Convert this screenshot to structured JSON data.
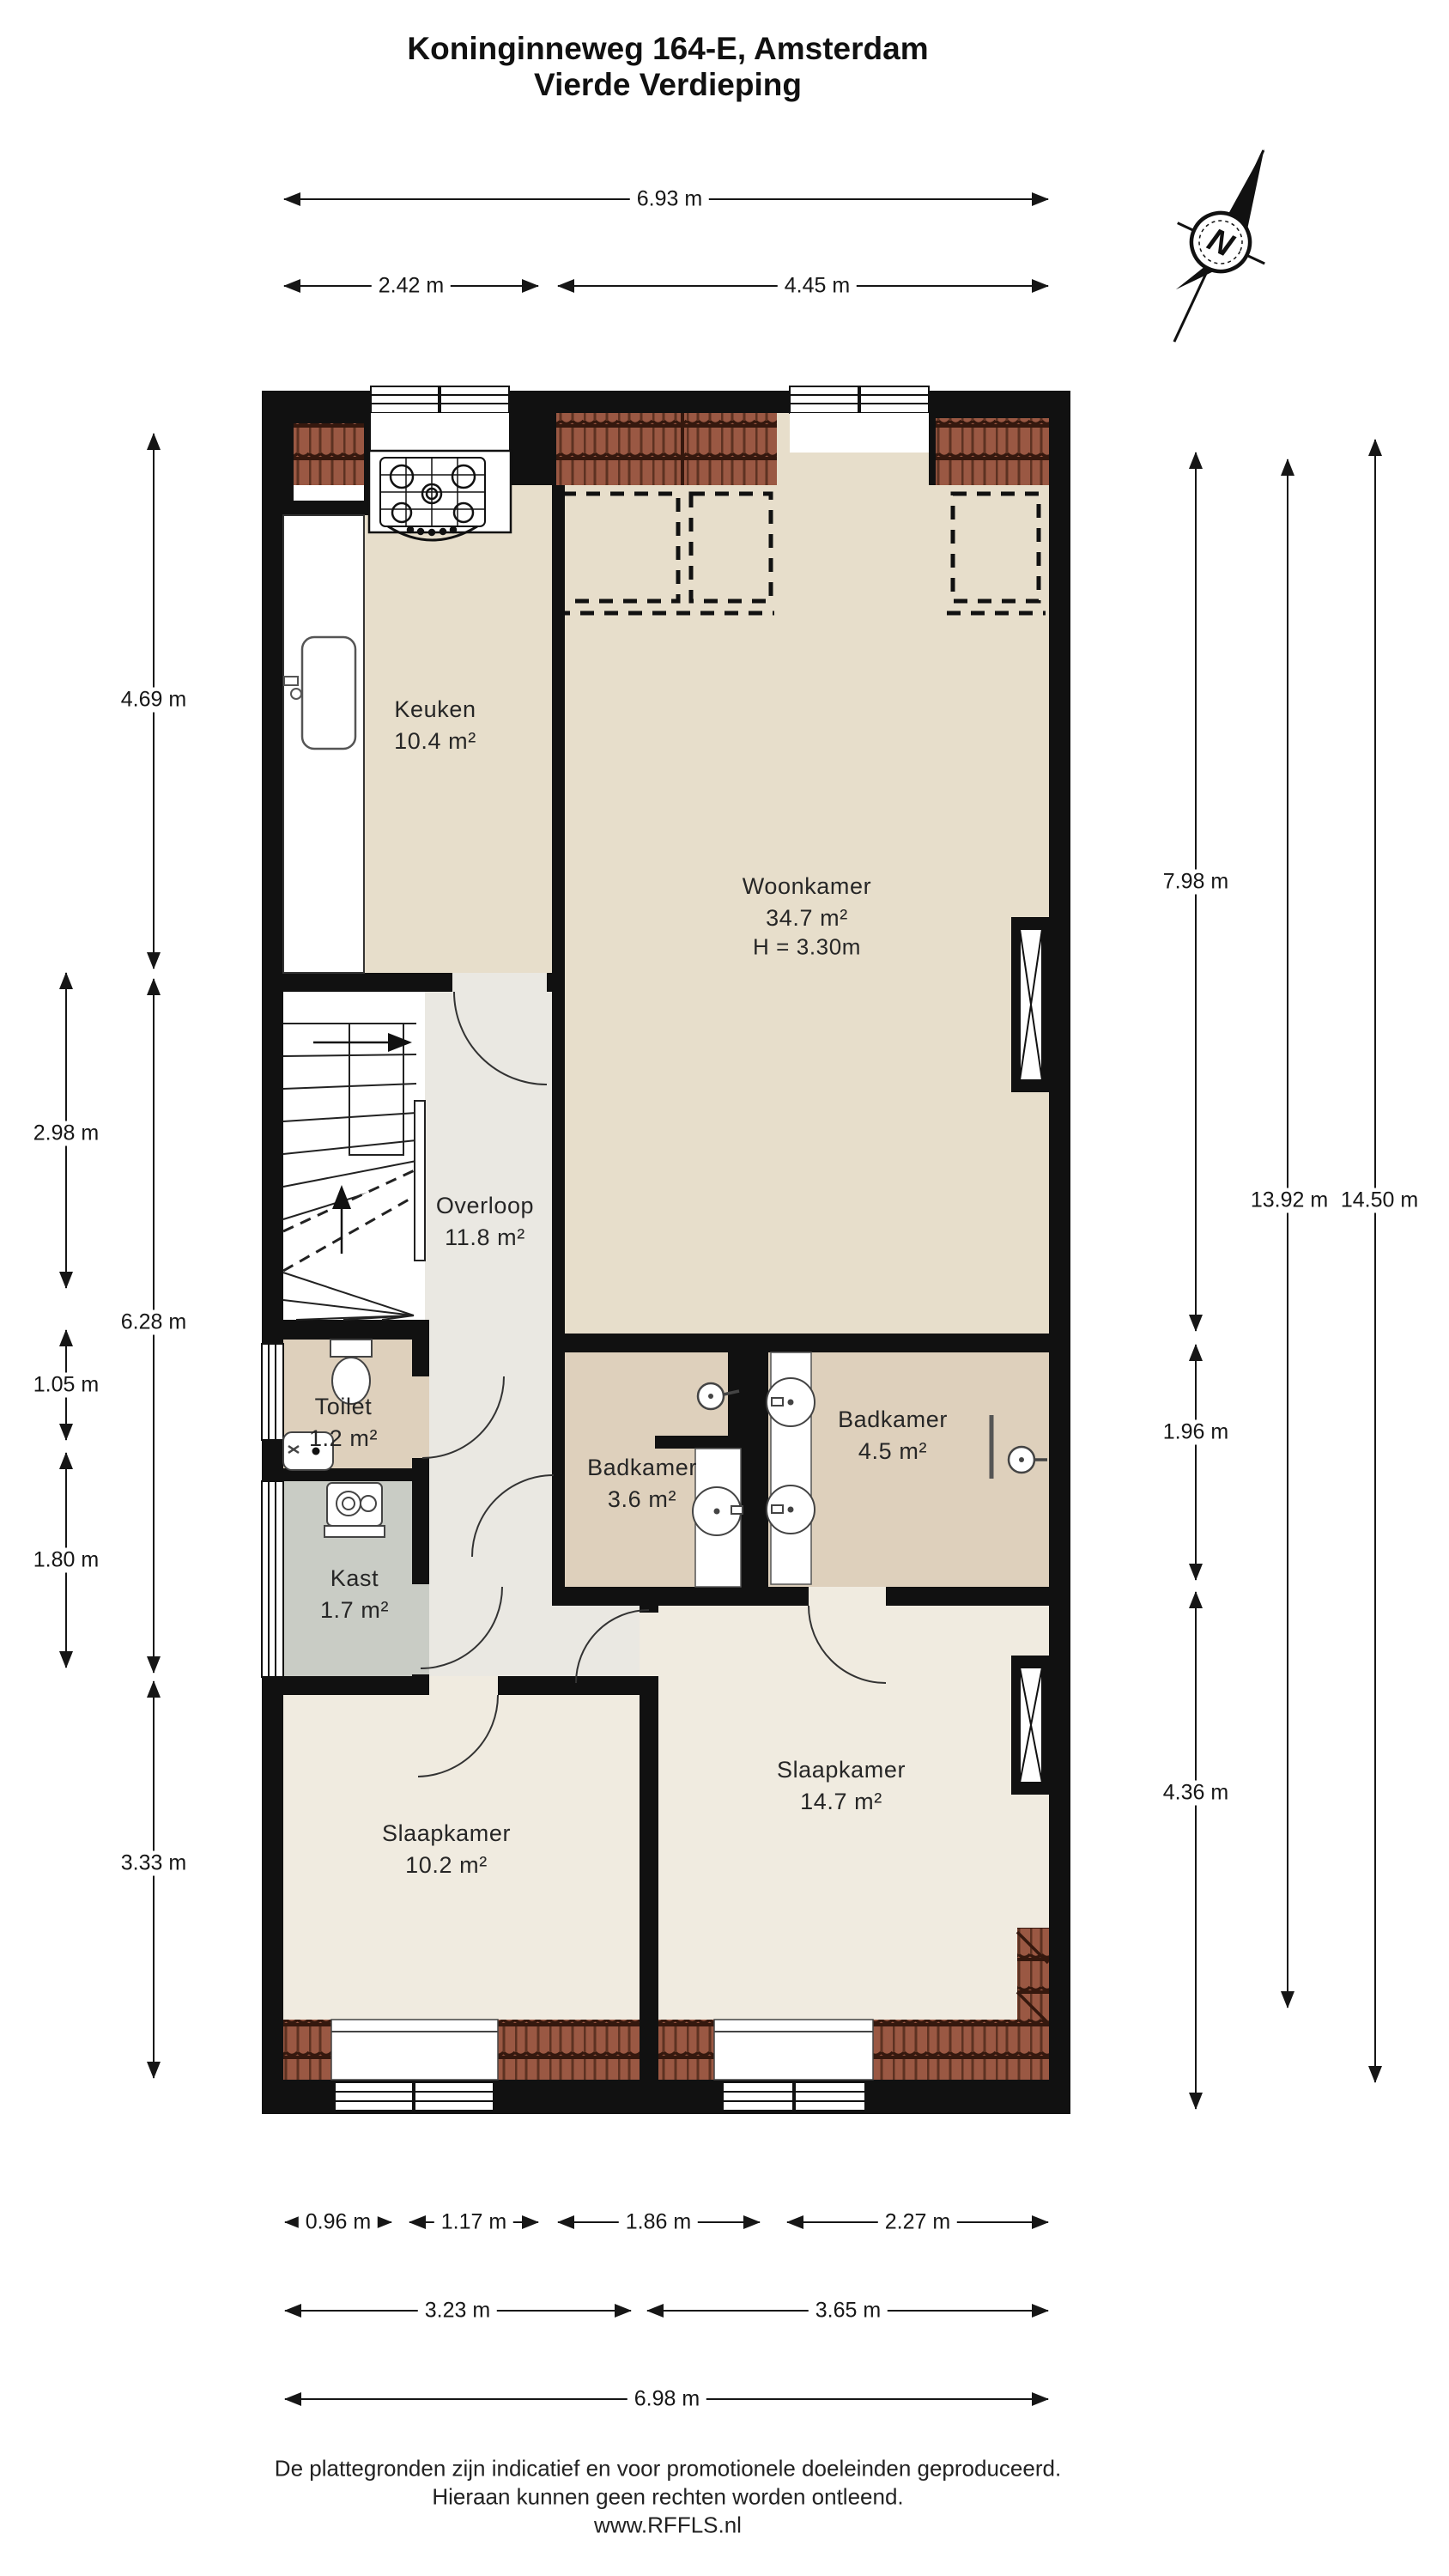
{
  "title": {
    "line1": "Koninginneweg 164-E, Amsterdam",
    "line2": "Vierde Verdieping"
  },
  "compass": {
    "label": "N"
  },
  "rooms": {
    "keuken": {
      "name": "Keuken",
      "area": "10.4 m²"
    },
    "woonkamer": {
      "name": "Woonkamer",
      "area": "34.7 m²",
      "ceiling_height": "H = 3.30m"
    },
    "overloop": {
      "name": "Overloop",
      "area": "11.8 m²"
    },
    "toilet": {
      "name": "Toilet",
      "area": "1.2 m²"
    },
    "badkamer_klein": {
      "name": "Badkamer",
      "area": "3.6 m²"
    },
    "badkamer_groot": {
      "name": "Badkamer",
      "area": "4.5 m²"
    },
    "kast": {
      "name": "Kast",
      "area": "1.7 m²"
    },
    "slaapkamer_klein": {
      "name": "Slaapkamer",
      "area": "10.2 m²"
    },
    "slaapkamer_groot": {
      "name": "Slaapkamer",
      "area": "14.7 m²"
    }
  },
  "dimensions": {
    "top_total": "6.93 m",
    "top_left": "2.42 m",
    "top_right": "4.45 m",
    "left_keuken": "4.69 m",
    "left_trap": "2.98 m",
    "left_mid": "6.28 m",
    "left_toilet": "1.05 m",
    "left_kast": "1.80 m",
    "left_slaapkamer": "3.33 m",
    "right_woonkamer": "7.98 m",
    "right_badkamer": "1.96 m",
    "right_slaapkamer": "4.36 m",
    "right_inner_total": "13.92 m",
    "right_outer_total": "14.50 m",
    "bottom_seg_1": "0.96 m",
    "bottom_seg_2": "1.17 m",
    "bottom_seg_3": "1.86 m",
    "bottom_seg_4": "2.27 m",
    "bottom_left_total": "3.23 m",
    "bottom_right_total": "3.65 m",
    "bottom_total": "6.98 m"
  },
  "footer": {
    "line1": "De plattegronden zijn indicatief en voor promotionele doeleinden geproduceerd.",
    "line2": "Hieraan kunnen geen rechten worden ontleend.",
    "line3": "www.RFFLS.nl"
  },
  "colors": {
    "wall": "#111111",
    "floor_main": "#e7decb",
    "floor_hall": "#eae8e2",
    "floor_bedroom": "#f0ebe0",
    "floor_bath": "#ded0bc",
    "floor_closet": "#c9ccc5",
    "roof_tile": "#9a5843",
    "roof_tile_dark": "#35180e"
  }
}
